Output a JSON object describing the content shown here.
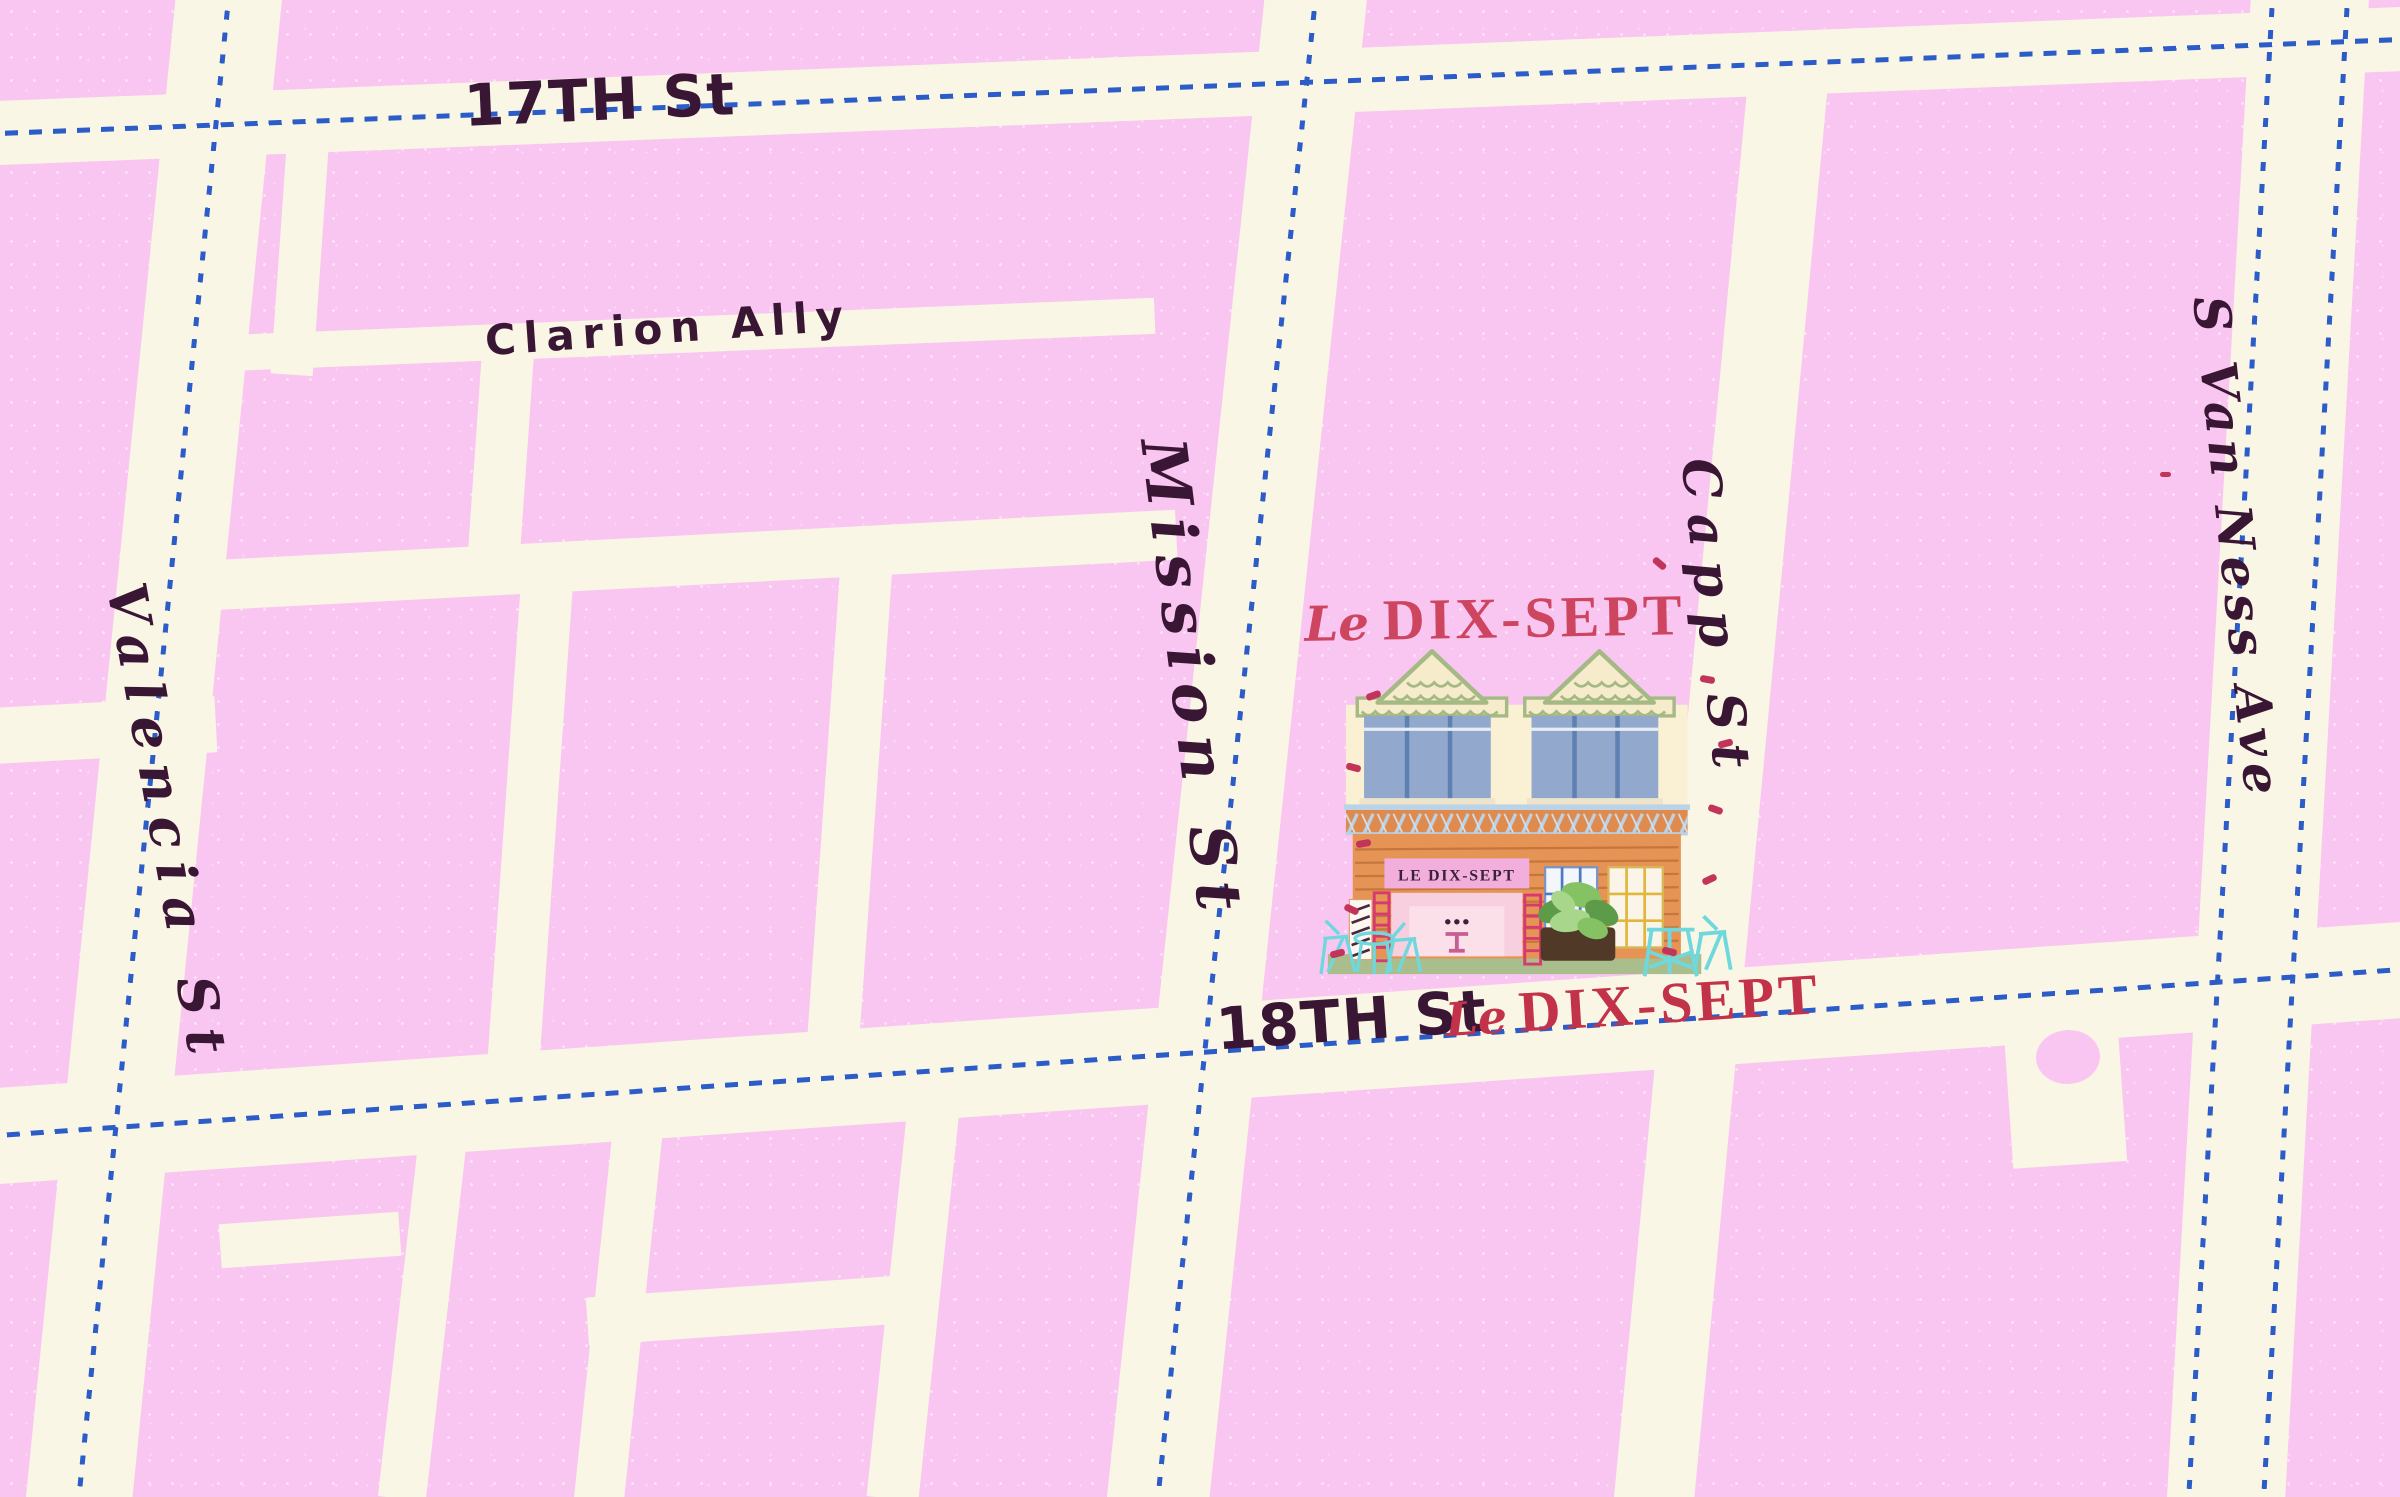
{
  "palette": {
    "background_pink": "#F9C6F2",
    "street_cream": "#FAF6E6",
    "dotted_route_blue": "#2B5CC8",
    "label_ink": "#3A1635",
    "poi_red": "#C23349"
  },
  "labels": {
    "street_17th": "17TH St",
    "clarion_alley": "Clarion Ally",
    "mission": "Mission St",
    "capp": "Capp St",
    "valencia": "Valencia St",
    "s_van_ness": "S Van Ness Ave",
    "street_18th": "18TH St"
  },
  "poi": {
    "name_script_prefix": "Le",
    "name_main": "DIX-SEPT",
    "building_sign": "LE DIX-SEPT",
    "map_label_script_prefix": "Le",
    "map_label_main": "DIX-SEPT"
  }
}
